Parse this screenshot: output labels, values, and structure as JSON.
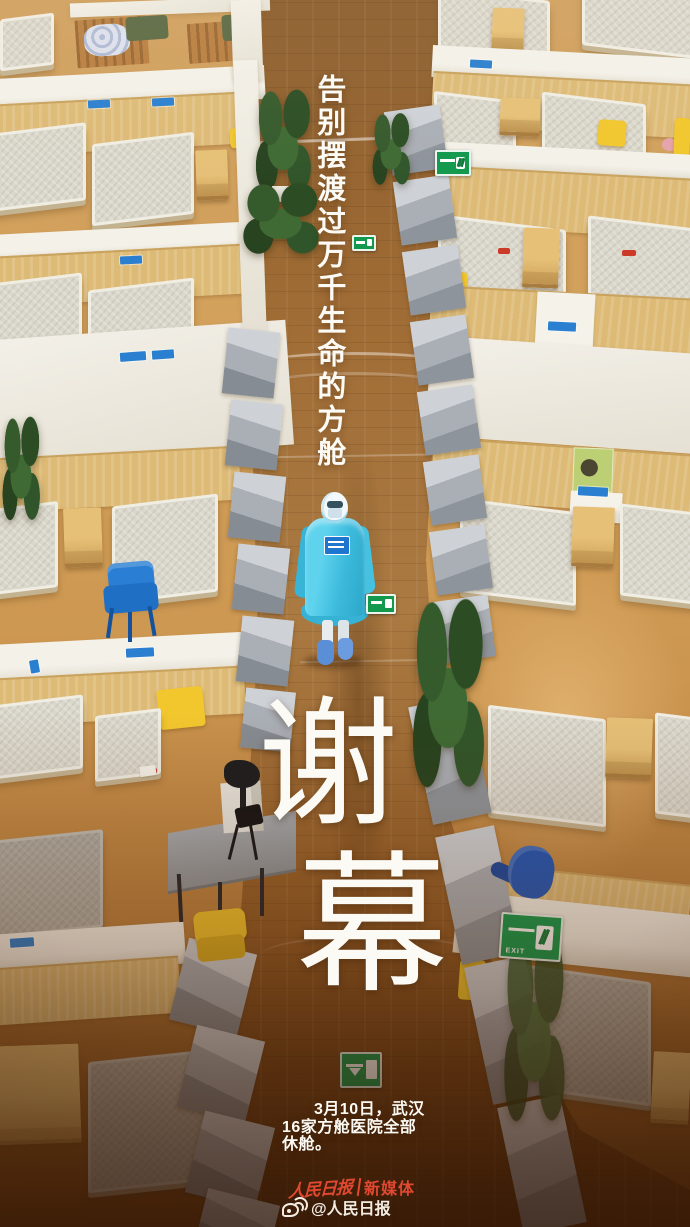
{
  "poster": {
    "headline": "告别摆渡过万千生命的方舱",
    "title": {
      "char1": "谢",
      "char2": "幕"
    },
    "caption": {
      "line1": "3月10日，武汉",
      "line2": "16家方舱医院全部",
      "line3": "休舱。"
    },
    "footer": {
      "masthead": "人民日报",
      "suffix": "新媒体",
      "handle": "@人民日报"
    },
    "signs": {
      "exit_label": "EXIT"
    },
    "colors": {
      "accent_red": "#e24830",
      "ppe_cyan": "#45c6e6",
      "exit_green": "#12994e",
      "chair_blue": "#1f6fc5",
      "floor_wood": "#cc9650",
      "walkway_wood": "#a06c35"
    }
  }
}
